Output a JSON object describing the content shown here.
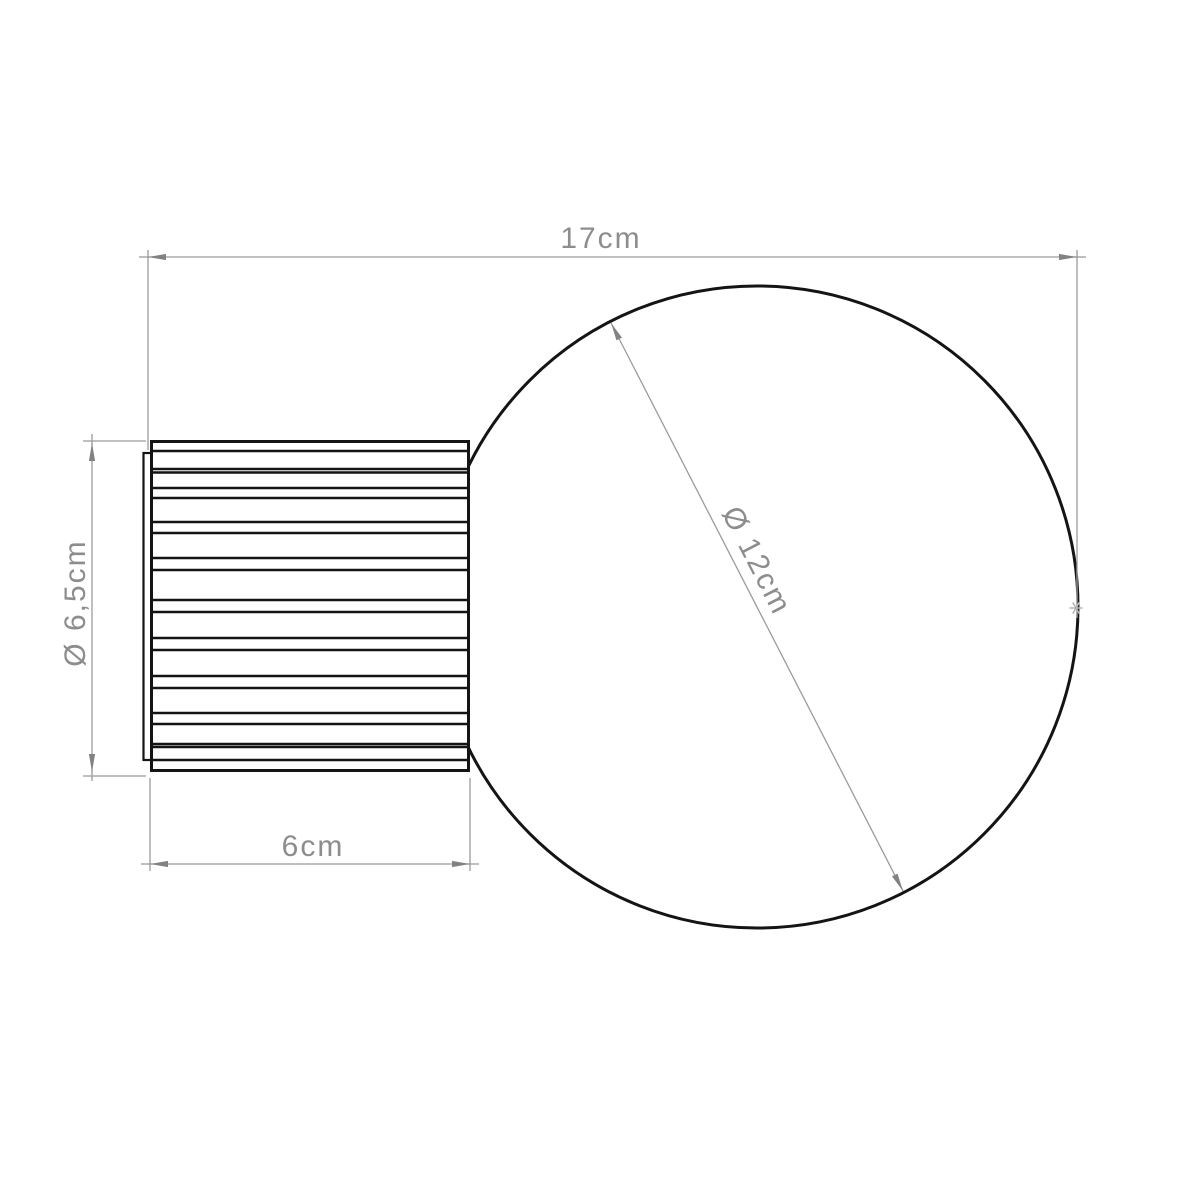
{
  "page": {
    "background": "#ffffff"
  },
  "style": {
    "outline_color": "#141414",
    "dim_line_color": "#9b9b9b",
    "dim_text_color": "#8d8d8d",
    "arrow_color": "#828282",
    "marker_color": "#b5b5b5",
    "page_bg": "#ffffff"
  },
  "labels": {
    "total_length": "17cm",
    "base_length": "6cm",
    "base_diameter": "Ø 6,5cm",
    "sphere_diameter": "Ø 12cm"
  },
  "geometry": {
    "sphere": {
      "cx": 757,
      "cy": 607,
      "r": 321
    },
    "base_box": {
      "x": 151.5,
      "y": 441.5,
      "width": 317,
      "height": 329
    },
    "back_plate": {
      "x": 143.5,
      "y": 453,
      "width": 9,
      "height": 307
    },
    "rib_lines_y": [
      451,
      469,
      472.5,
      488,
      498,
      522,
      533,
      558,
      570,
      600,
      612,
      638,
      650,
      676,
      688,
      713,
      724,
      744,
      747,
      760
    ],
    "dim_total": {
      "line": [
        148,
        257,
        1077,
        257
      ],
      "tail_left": [
        139,
        257,
        150,
        257
      ],
      "tail_right": [
        1075,
        257,
        1086,
        257
      ],
      "ext_left": [
        148,
        250,
        148,
        450
      ],
      "ext_right": [
        1077,
        250,
        1077,
        618
      ],
      "label": {
        "x": 601,
        "y": 248,
        "angle": 0
      }
    },
    "dim_base_diameter": {
      "line": [
        92,
        443,
        92,
        772
      ],
      "tail_top": [
        92,
        434,
        92,
        445
      ],
      "tail_bottom": [
        92,
        770,
        92,
        781
      ],
      "ext_top": [
        83,
        441,
        146,
        441
      ],
      "ext_bottom": [
        83,
        776,
        146,
        776
      ],
      "label": {
        "x": 85,
        "y": 603,
        "angle": -90
      }
    },
    "dim_base_length": {
      "line": [
        150,
        864,
        470,
        864
      ],
      "tail_left": [
        141,
        864,
        152,
        864
      ],
      "tail_right": [
        468,
        864,
        479,
        864
      ],
      "ext_left": [
        150,
        778,
        150,
        871
      ],
      "ext_right": [
        470,
        778,
        470,
        871
      ],
      "label": {
        "x": 313,
        "y": 856,
        "angle": 0
      }
    },
    "dim_sphere_diameter": {
      "line": [
        611,
        323,
        903,
        891
      ],
      "label": {
        "x": 748,
        "y": 565,
        "angle": 62.8
      }
    },
    "tangent_marker": {
      "x": 1076,
      "y": 608,
      "r": 6.5
    }
  }
}
